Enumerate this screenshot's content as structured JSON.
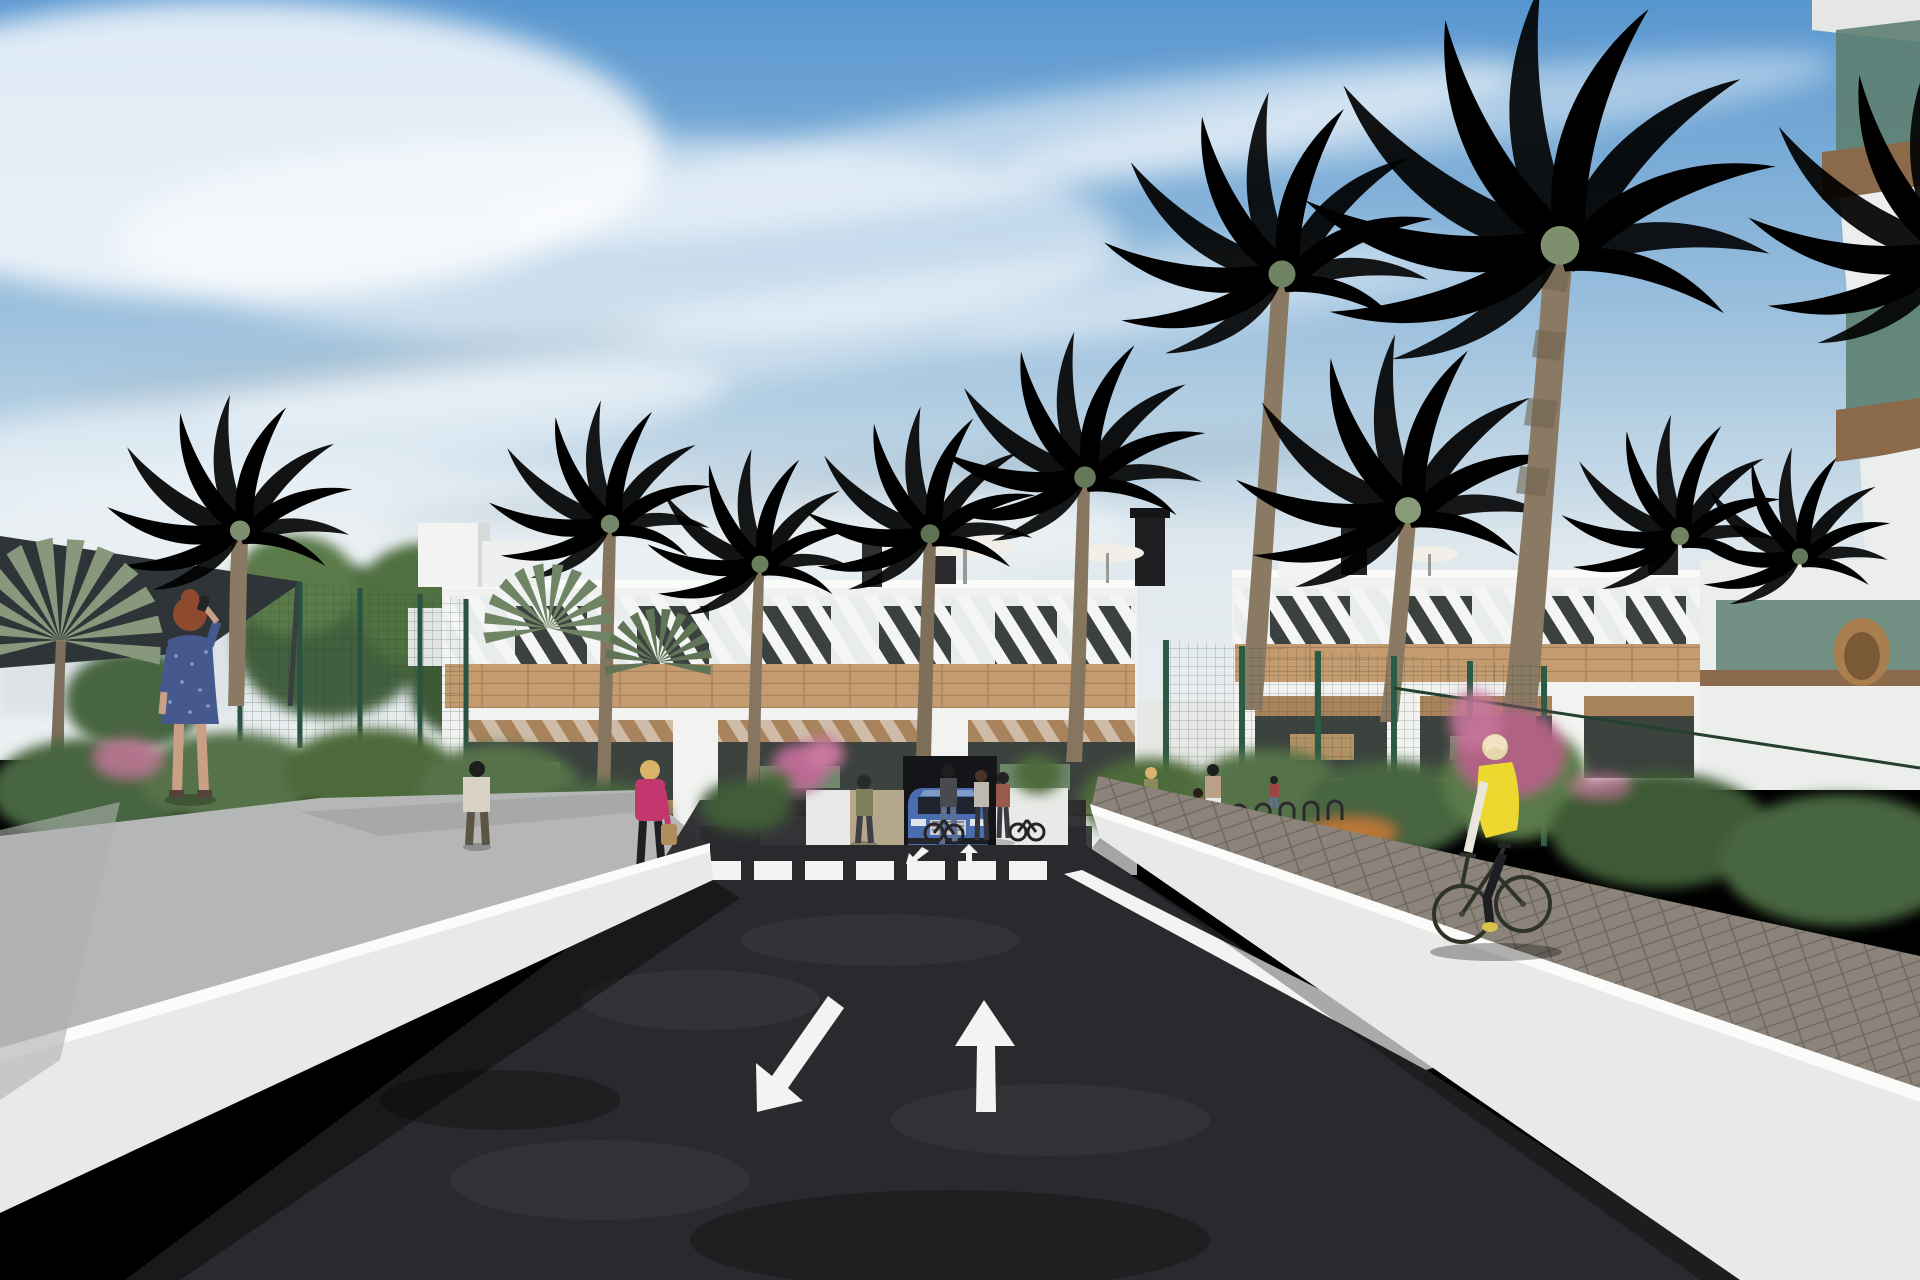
{
  "scene": {
    "type": "architectural_rendering",
    "description": "Street-level 3D visualization of a modern white Mediterranean apartment complex with palm trees. A two-way asphalt drive with painted lane arrows leads over a zebra crossing to a garage entrance where a blue SUV waits. Pedestrians walk the side paths and a senior cyclist in a yellow vest rides the paved lane on the right.",
    "sky": {
      "condition": "sunny",
      "clouds": "wispy cirrus streaks"
    },
    "palette": {
      "sky_top": "#5896cf",
      "sky_mid": "#a6c6e0",
      "sky_horizon": "#e9edf1",
      "cloud": "#ffffff",
      "building_white": "#f1f2f0",
      "building_shade": "#d9dcda",
      "wood": "#c49c70",
      "pergola": "#a8835c",
      "glass_dark": "#3a413e",
      "glass_teal": "#5d7f71",
      "slab_brown": "#8a6a4a",
      "fence_green": "#2e5d49",
      "foliage_dark": "#3c5a36",
      "foliage_mid": "#55724a",
      "foliage_light": "#72885f",
      "palm_olive": "#6d8160",
      "palm_gray": "#8b9c7d",
      "trunk_brown": "#8a7a63",
      "asphalt": "#2a292d",
      "marking_white": "#f3f3f1",
      "wall_white": "#e9eae8",
      "wall_top": "#fbfbf9",
      "sidewalk_gray": "#b4b7b5",
      "paver_gray": "#8c847a",
      "paver_entrance": "#b5a78c",
      "flower_pink": "#bb6b94",
      "flower_orange": "#d07a33",
      "car_blue": "#4a6cb0",
      "car_grille": "#c9ccd1",
      "sail_dark": "#2f3438",
      "vest_yellow": "#ecd82f",
      "jacket_pink": "#c2376e",
      "dress_blue": "#46598f",
      "skin": "#c9a086",
      "hair_red": "#8d4a2e",
      "hair_blond": "#d9b36a",
      "bag_tan": "#b08d5f",
      "umbrella_white": "#f1efe8",
      "bike_dark": "#2e3328"
    },
    "road": {
      "lanes": 2,
      "surface": "dark asphalt",
      "markings": [
        "down-left lane arrow",
        "up lane arrow",
        "zebra crosswalk",
        "two small arrows at garage entrance",
        "white edge line"
      ]
    },
    "buildings": [
      "three-story white apartment block with wood-clad bands, slatted pergolas and glazed terraces (center)",
      "matching apartment block behind green sports-court fencing (right)",
      "foreground balcony corner with tinted glass railings (top right)"
    ],
    "vegetation": [
      "tall date palms",
      "fan palms",
      "leafy green trees",
      "garden beds with orange flowers",
      "pink bougainvillea shrubs",
      "hedges"
    ],
    "vehicle": {
      "type": "SUV",
      "color_name": "blue",
      "position": "at the garage entrance facing the viewer"
    },
    "people": [
      {
        "id": "phone-woman",
        "desc": "red-haired woman in a blue patterned dress making a phone call",
        "position": "left walkway"
      },
      {
        "id": "man-by-fence",
        "desc": "man in a light shirt standing by the green court fence",
        "position": "left garden path"
      },
      {
        "id": "pink-jacket-woman",
        "desc": "blonde woman in a pink jacket carrying a tan handbag",
        "position": "left walkway near the wall"
      },
      {
        "id": "entrance-pedestrian",
        "desc": "woman in an olive top on the entrance walkway beside the SUV",
        "position": "garage entrance"
      },
      {
        "id": "pedestrian-group-left",
        "desc": "three people standing by parked bicycles right of the entrance",
        "position": "entrance plaza"
      },
      {
        "id": "pedestrian-group-right",
        "desc": "family group near the bicycle racks",
        "position": "right walkway"
      },
      {
        "id": "cyclist",
        "desc": "senior cyclist in a yellow vest on a dark-green bicycle",
        "position": "right paved path"
      }
    ],
    "furniture": [
      "white patio umbrellas on roof terraces",
      "green terrace chairs and loungers",
      "bicycle racks",
      "hanging rattan chair"
    ]
  }
}
